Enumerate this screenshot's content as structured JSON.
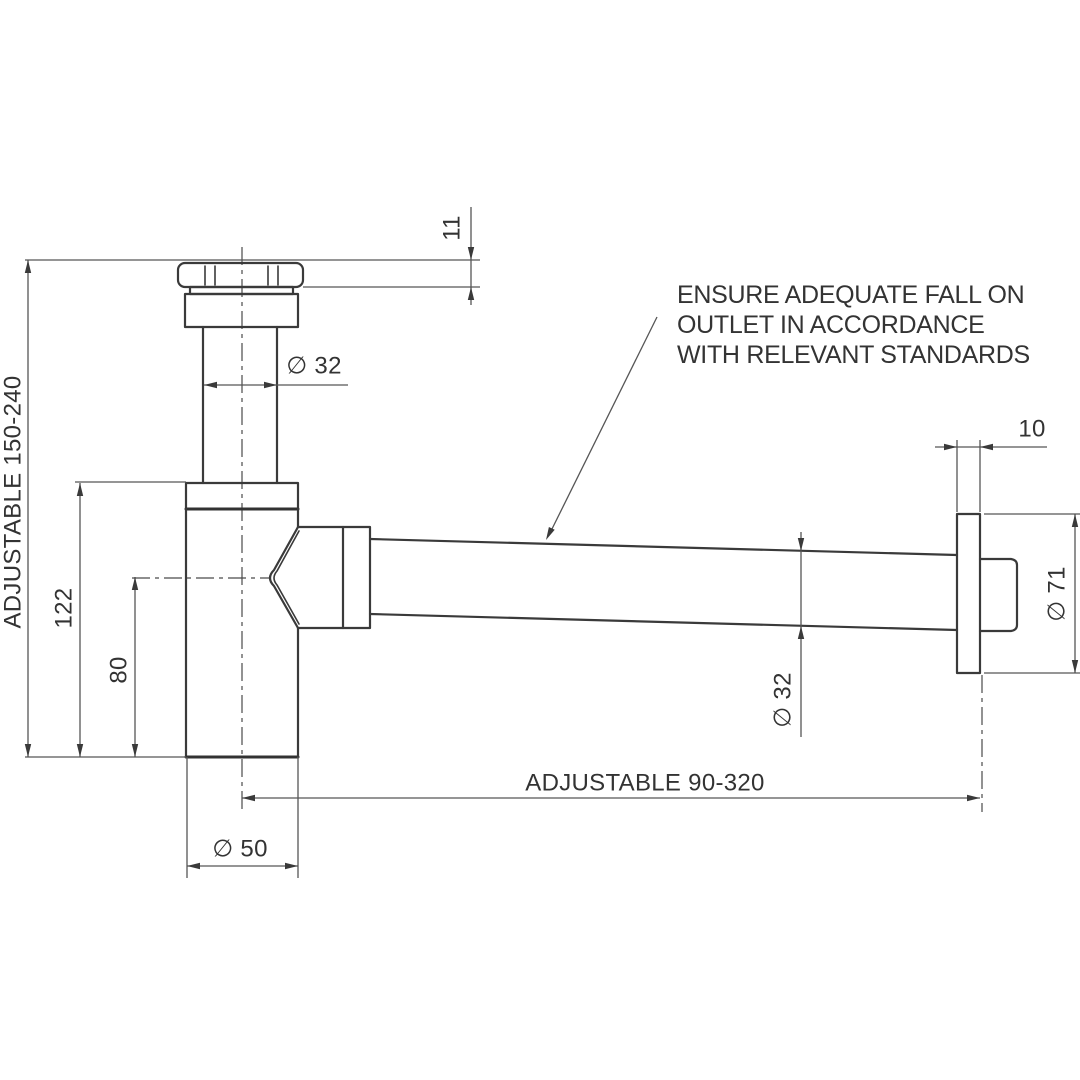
{
  "note": {
    "lines": [
      "ENSURE ADEQUATE FALL ON",
      "OUTLET IN ACCORDANCE",
      "WITH RELEVANT STANDARDS"
    ]
  },
  "dimensions": {
    "nut_height": "11",
    "inlet_pipe_diameter": "∅ 32",
    "inlet_adjustable_range": "ADJUSTABLE 150-240",
    "body_height": "122",
    "outlet_centre_height": "80",
    "body_diameter": "∅ 50",
    "outlet_adjustable_range": "ADJUSTABLE 90-320",
    "outlet_pipe_diameter": "∅ 32",
    "flange_depth": "10",
    "flange_diameter": "∅ 71"
  },
  "colors": {
    "background": "#ffffff",
    "outline": "#3a3a3a",
    "dimension_line": "#565656",
    "text": "#333333"
  }
}
